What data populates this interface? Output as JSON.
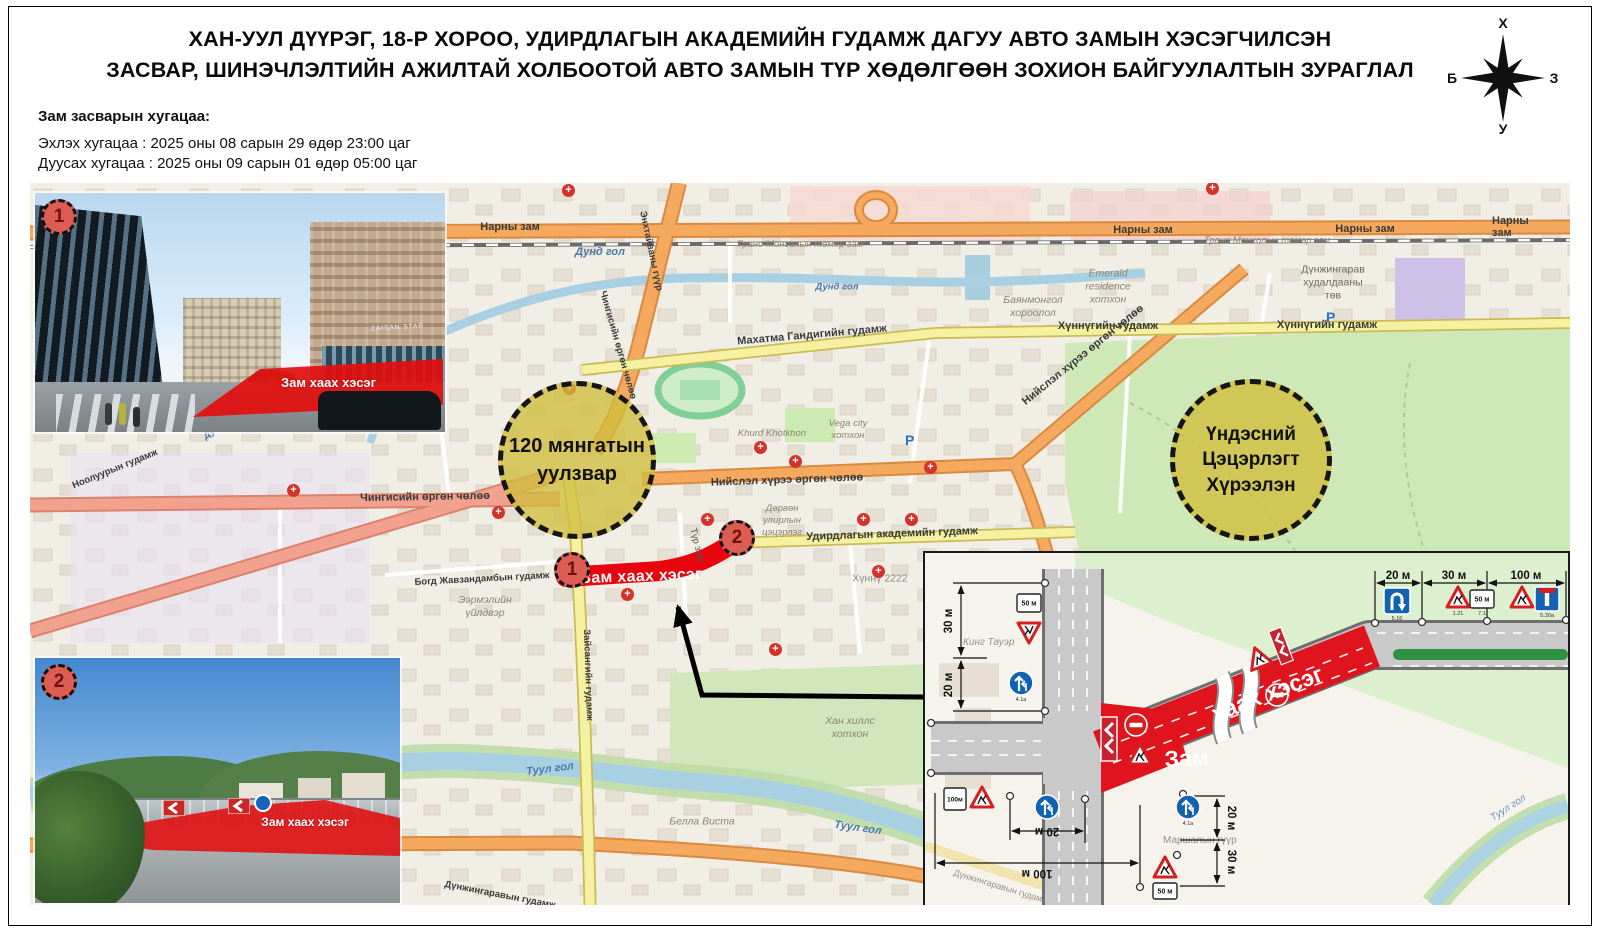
{
  "header": {
    "title_line1": "ХАН-УУЛ ДҮҮРЭГ, 18-Р ХОРОО, УДИРДЛАГЫН АКАДЕМИЙН ГУДАМЖ ДАГУУ АВТО ЗАМЫН ХЭСЭГЧИЛСЭН",
    "title_line2": "ЗАСВАР,  ШИНЭЧЛЭЛТИЙН АЖИЛТАЙ ХОЛБООТОЙ АВТО ЗАМЫН ТҮР ХӨДӨЛГӨӨН ЗОХИОН БАЙГУУЛАЛТЫН ЗУРАГЛАЛ"
  },
  "schedule": {
    "heading": "Зам засварын хугацаа:",
    "start": "Эхлэх хугацаа : 2025 оны 08 сарын 29 өдөр 23:00 цаг",
    "end": "Дуусах хугацаа : 2025 оны 09 сарын 01 өдөр 05:00 цаг"
  },
  "compass": {
    "north": "Х",
    "south": "У",
    "west": "Б",
    "east": "З"
  },
  "map": {
    "cross_symbol": "+",
    "parking_symbol": "P",
    "crosses": [
      [
        263,
        307
      ],
      [
        468,
        329
      ],
      [
        677,
        336
      ],
      [
        765,
        278
      ],
      [
        833,
        336
      ],
      [
        881,
        336
      ],
      [
        848,
        388
      ],
      [
        900,
        284
      ],
      [
        745,
        466
      ],
      [
        1182,
        5
      ],
      [
        539,
        205
      ],
      [
        730,
        264
      ],
      [
        597,
        411
      ],
      [
        538,
        7
      ]
    ],
    "parkings": [
      [
        875,
        249
      ],
      [
        1296,
        126
      ]
    ],
    "zones": {
      "junction120": "120 мянгатын\nуулзвар",
      "national_park": "Үндэсний\nЦэцэрлэгт\nХүрээлэн"
    },
    "closure": {
      "label": "Зам хаах хэсэг",
      "marker1": "1",
      "marker2": "2",
      "temp_road": "Түр зам"
    },
    "streets": {
      "narny": "Нарны зам",
      "railway": "Транс-Монголын төмөр зам",
      "dund_gol": "Дунд гол",
      "enkhtaivan_bridge": "Энхтайваны гүүр",
      "chinggis_ave": "Чингисийн өргөн чөлөө",
      "gandhi": "Махатма Гандигийн гудамж",
      "khunnu": "Хүннүгийн гудамж",
      "niislel_khuree": "Нийслэл хүрээ өргөн чөлөө",
      "udirdlaga": "Удирдлагын академийн гудамж",
      "bogd": "Богд Жавзандамбын гудамж",
      "nooluur": "Ноолуурын гудамж",
      "zaisan": "Зайсангийн гудамж",
      "dunjingarav": "Дүнжингаравын гудамж",
      "tuul_gol": "Туул гол"
    },
    "places": {
      "mall": "Дүнжингарав\nхудалдааны\nтөв",
      "emerald": "Emerald\nresidence\nхотхон",
      "bayanmongol": "Баянмонгол\nхороолол",
      "khunnu2222": "Хүннү 2222",
      "four_seasons": "Дөрвөн\nулирлын\nцэцэрлэг",
      "eermel": "Ээрмэлийн\nүйлдвэр",
      "khurd": "Khurd Khotkhon",
      "vega": "Vega city\nхотхон",
      "bella_vista": "Белла Виста",
      "khan_hills": "Хан хиллс\nхотхон"
    }
  },
  "photos": {
    "photo1": {
      "number": "1",
      "caption": "Зам хаах хэсэг",
      "building_sign": "ZAISAN STAR"
    },
    "photo2": {
      "number": "2",
      "caption": "Зам хаах хэсэг"
    }
  },
  "diagram": {
    "closure_word1": "Зам",
    "closure_word2": "хаах хэсэг",
    "dims": {
      "top_20": "20 м",
      "top_30": "30 м",
      "top_100": "100 м",
      "left_30": "30 м",
      "left_20": "20 м",
      "right_20": "20 м",
      "right_30": "30 м",
      "bottom_20": "20 м",
      "bottom_100": "100 м"
    },
    "plates": {
      "p50": "50 м",
      "p100": "100м"
    },
    "codes": {
      "uturn": "5.16",
      "works": "1.21",
      "plate": "7.1",
      "dir": "4.1а",
      "deadend": "5.30а"
    },
    "labels": {
      "king_tower": "Кинг Тауэр",
      "marshal_bridge": "Маршалын гүүр",
      "tuul_gol": "Туул гол",
      "dunjingarav": "Дүнжингаравын гудамж"
    }
  }
}
